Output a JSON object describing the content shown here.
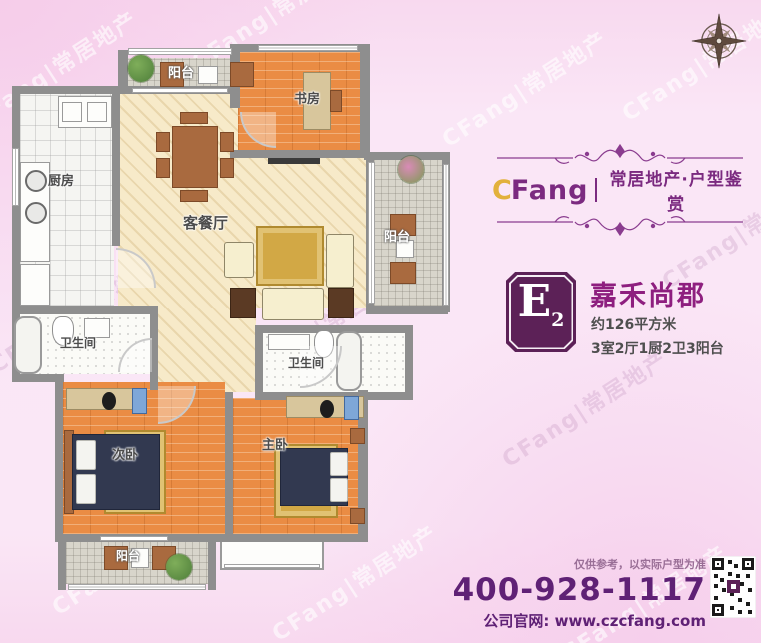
{
  "watermark": {
    "text": "CFang|常居地产"
  },
  "brand": {
    "logo_c": "C",
    "logo_rest": "Fang",
    "tagline": "常居地产·户型鉴赏",
    "accent_gold": "#e2b13c",
    "purple": "#7b2a80"
  },
  "unit_badge": {
    "letter": "E",
    "number": "2",
    "caption": "户型"
  },
  "listing": {
    "name": "嘉禾尚郡",
    "area": "约126平方米",
    "rooms": "3室2厅1厨2卫3阳台",
    "title_color": "#8e1f7f"
  },
  "footer": {
    "disclaimer": "仅供参考，以实际户型为准",
    "phone": "400-928-1117",
    "website": "公司官网: www.czcfang.com",
    "phone_color": "#5f2175"
  },
  "floorplan": {
    "labels": {
      "balcony_top": "阳台",
      "study": "书房",
      "kitchen": "厨房",
      "living": "客餐厅",
      "balcony_right": "阳台",
      "bath_left": "卫生间",
      "bath_right": "卫生间",
      "bedroom_second": "次卧",
      "bedroom_master": "主卧",
      "balcony_bottom": "阳台"
    },
    "colors": {
      "wall": "#8e8e8e",
      "wood_floor": "#ea8c44",
      "living_floor": "#f7eac9"
    }
  },
  "icons": {
    "compass": "compass-rose",
    "qr": "qr-code",
    "flourish": "decorative-flourish"
  }
}
